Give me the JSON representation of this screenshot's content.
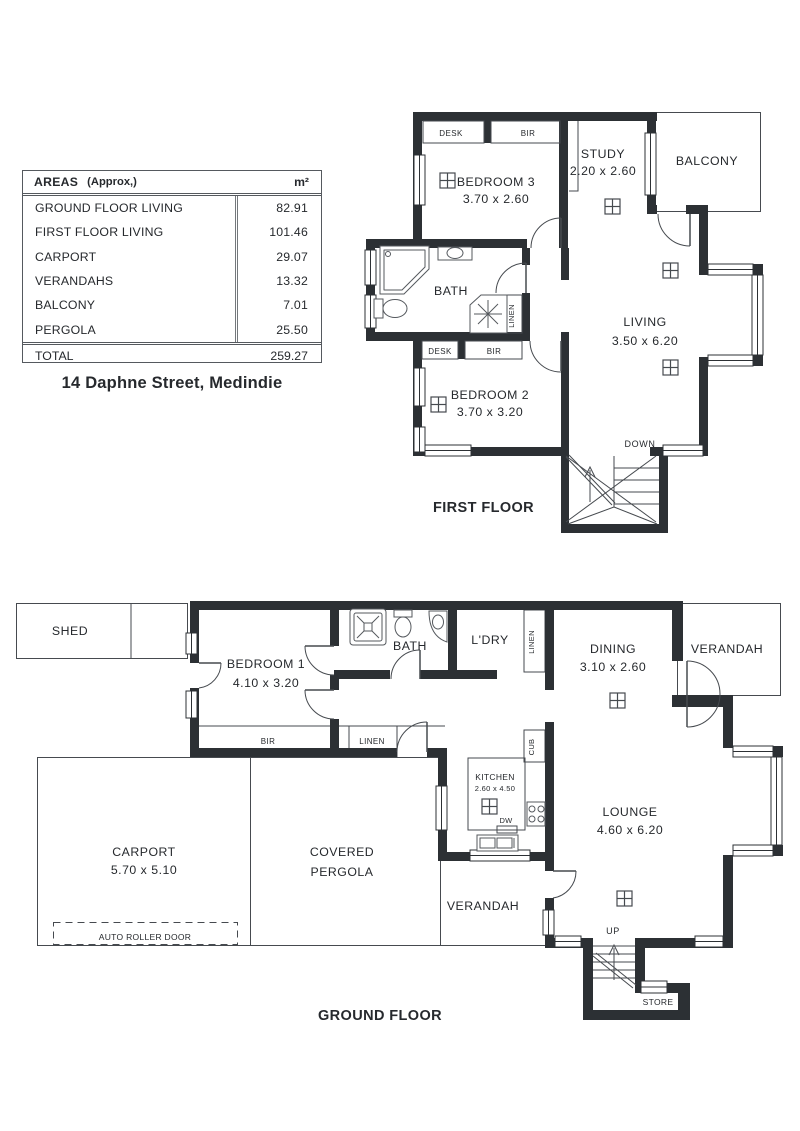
{
  "areas_table": {
    "header": {
      "title": "AREAS",
      "qualifier": "(Approx,)",
      "unit": "m²"
    },
    "rows": [
      {
        "label": "GROUND FLOOR LIVING",
        "value": "82.91"
      },
      {
        "label": "FIRST FLOOR LIVING",
        "value": "101.46"
      },
      {
        "label": "CARPORT",
        "value": "29.07"
      },
      {
        "label": "VERANDAHS",
        "value": "13.32"
      },
      {
        "label": "BALCONY",
        "value": "7.01"
      },
      {
        "label": "PERGOLA",
        "value": "25.50"
      }
    ],
    "total": {
      "label": "TOTAL",
      "value": "259.27"
    }
  },
  "address": "14 Daphne Street, Medindie",
  "first_floor": {
    "title": "FIRST FLOOR",
    "labels": {
      "desk_bed3": "DESK",
      "bir_bed3": "BIR",
      "bedroom3_name": "BEDROOM 3",
      "bedroom3_dims": "3.70 x 2.60",
      "study_name": "STUDY",
      "study_dims": "2.20 x 2.60",
      "balcony": "BALCONY",
      "bath": "BATH",
      "linen": "LINEN",
      "desk_bed2": "DESK",
      "bir_bed2": "BIR",
      "bedroom2_name": "BEDROOM 2",
      "bedroom2_dims": "3.70 x 3.20",
      "living_name": "LIVING",
      "living_dims": "3.50 x 6.20",
      "down": "DOWN"
    }
  },
  "ground_floor": {
    "title": "GROUND FLOOR",
    "labels": {
      "shed": "SHED",
      "bedroom1_name": "BEDROOM 1",
      "bedroom1_dims": "4.10 x 3.20",
      "bath": "BATH",
      "ldry": "L'DRY",
      "linen_upper": "LINEN",
      "dining_name": "DINING",
      "dining_dims": "3.10 x 2.60",
      "verandah_upper": "VERANDAH",
      "bir": "BIR",
      "linen_lower": "LINEN",
      "kitchen_name": "KITCHEN",
      "kitchen_dims": "2.60 x 4.50",
      "dw": "DW",
      "cub": "CUB",
      "lounge_name": "LOUNGE",
      "lounge_dims": "4.60 x 6.20",
      "verandah_lower": "VERANDAH",
      "up": "UP",
      "store": "STORE",
      "carport_name": "CARPORT",
      "carport_dims": "5.70 x 5.10",
      "pergola_line1": "COVERED",
      "pergola_line2": "PERGOLA",
      "auto_roller_door": "AUTO ROLLER DOOR"
    }
  },
  "colors": {
    "wall": "#2c3034",
    "thin_line": "#464a4f",
    "text": "#26292d"
  }
}
